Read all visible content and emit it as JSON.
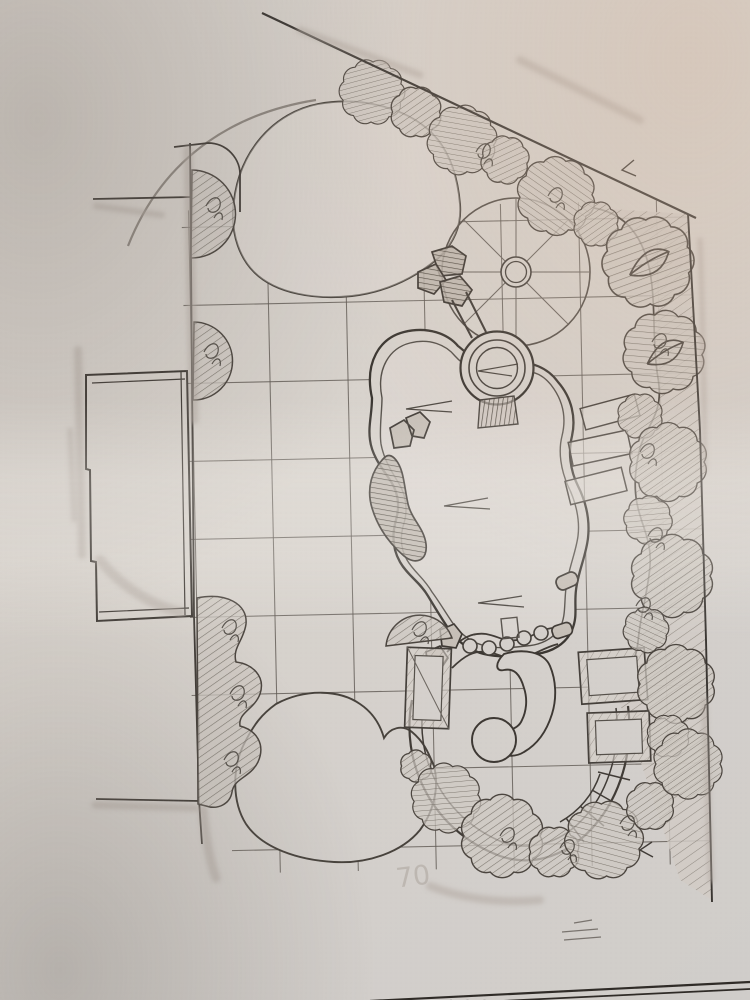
{
  "document": {
    "kind": "pencil landscape concept plan photo"
  },
  "colors": {
    "paper": "#d6d0ca",
    "pencil_dark": "#403b36",
    "pencil_mid": "#5f5953",
    "pencil_light": "#8d867f",
    "smudge": "#b2aaa2"
  },
  "annotations": {
    "ghost_text": "70",
    "edge_letters": "ZZZDOATESSSM"
  }
}
